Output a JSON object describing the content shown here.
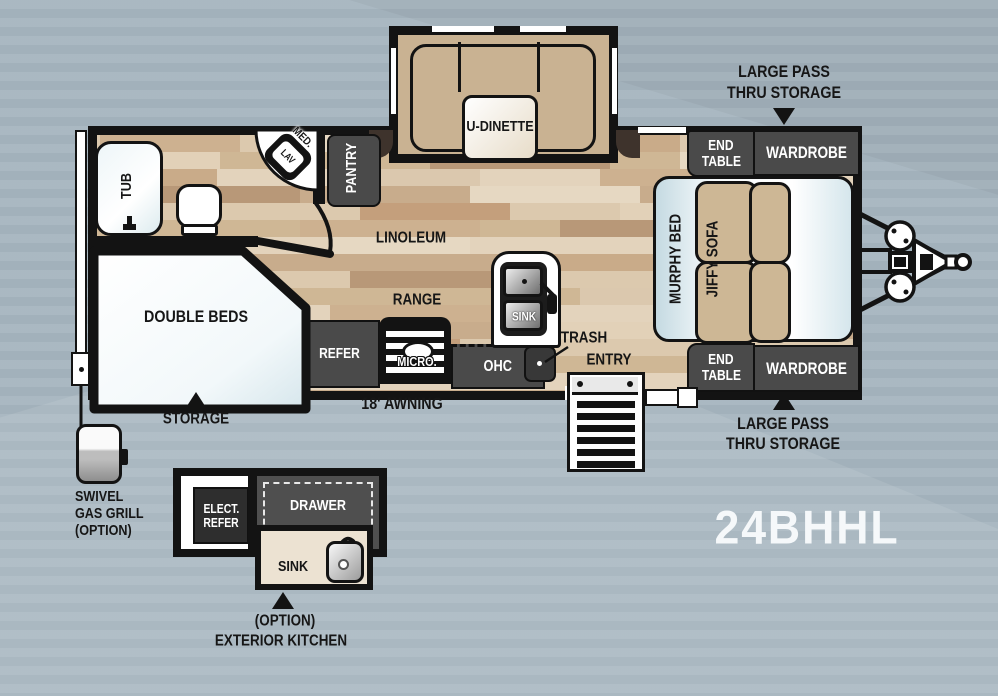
{
  "model": "24BHHL",
  "colors": {
    "background": "#a7b6c0",
    "wall": "#131313",
    "floor_base": "#d8c4a9",
    "cabinet_dark": "#4a4a4a",
    "cushion_tan": "#cdb795",
    "murphy_blue": "#cfe2ea",
    "model_text": "#f5f8fa"
  },
  "annotations": {
    "pass_thru_top": {
      "line1": "LARGE PASS",
      "line2": "THRU STORAGE"
    },
    "pass_thru_bottom": {
      "line1": "LARGE PASS",
      "line2": "THRU STORAGE"
    },
    "storage": "STORAGE",
    "awning": "18' AWNING",
    "entry": "ENTRY",
    "trash": "TRASH",
    "grill": {
      "line1": "SWIVEL",
      "line2": "GAS GRILL",
      "line3": "(OPTION)"
    },
    "ext_kitchen_caption": {
      "line1": "(OPTION)",
      "line2": "EXTERIOR KITCHEN"
    }
  },
  "interior": {
    "bathroom": {
      "tub": "TUB",
      "med": "MED.",
      "lav": "LAV"
    },
    "bedroom": {
      "double_beds": "DOUBLE BEDS"
    },
    "kitchen": {
      "pantry": "PANTRY",
      "refer": "REFER",
      "range": "RANGE",
      "micro": "MICRO.",
      "ohc": "OHC",
      "sink": "SINK",
      "linoleum": "LINOLEUM"
    },
    "dinette": {
      "label": "U-DINETTE"
    },
    "living": {
      "murphy_bed": "MURPHY BED",
      "jiffy_sofa": "JIFFY SOFA",
      "end_table": {
        "line1": "END",
        "line2": "TABLE"
      },
      "wardrobe": "WARDROBE"
    }
  },
  "exterior_kitchen": {
    "elect_refer": {
      "line1": "ELECT.",
      "line2": "REFER"
    },
    "drawer": "DRAWER",
    "sink": "SINK"
  }
}
